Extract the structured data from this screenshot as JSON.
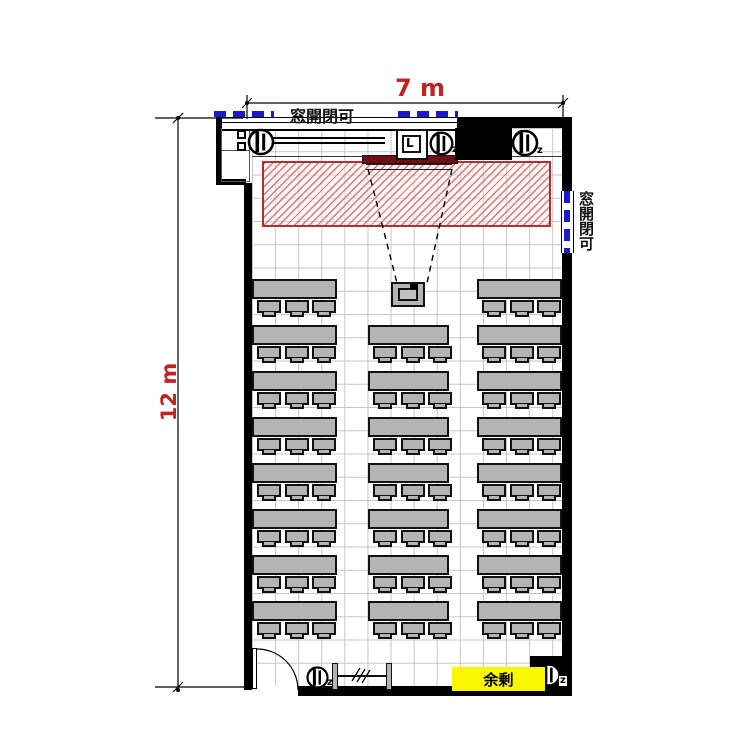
{
  "diagram": {
    "dimensions": {
      "width_label": "7 m",
      "height_label": "12 m",
      "color": "#c22222"
    },
    "windows": {
      "top_label": "窓開閉可",
      "right_label": "窓開閉可",
      "dash_color": "#1a1acc"
    },
    "labels": {
      "surplus": "余剰",
      "surplus_bg": "#f8f700",
      "clock": "L",
      "speaker_mark": "z"
    },
    "colors": {
      "wall": "#000000",
      "furniture": "#b4b4b4",
      "hatch_border": "#b03030",
      "hatch_line": "#d47a7a",
      "screen": "#6a1212",
      "grid": "#c6c6c6",
      "window_blue": "#1a1acc",
      "dimension_red": "#c22222"
    }
  },
  "floorplan": {
    "desks": {
      "table_height": 20,
      "chair": {
        "offsets": [
          5,
          33,
          60
        ],
        "width": 24,
        "height": 13,
        "tail_width": 14,
        "tail_height": 5
      },
      "columns": [
        {
          "name": "left",
          "x": 252,
          "width": 85,
          "rows": [
            279,
            325,
            371,
            417,
            463,
            509,
            555,
            601
          ]
        },
        {
          "name": "center",
          "x": 368,
          "width": 81,
          "rows": [
            325,
            371,
            417,
            463,
            509,
            555,
            601
          ]
        },
        {
          "name": "right",
          "x": 477,
          "width": 85,
          "rows": [
            279,
            325,
            371,
            417,
            463,
            509,
            555,
            601
          ]
        }
      ]
    },
    "speakers": [
      {
        "x": 246,
        "y": 127,
        "size": 30,
        "z": false,
        "on_dark": false
      },
      {
        "x": 428,
        "y": 130,
        "size": 27,
        "z": true,
        "on_dark": false
      },
      {
        "x": 510,
        "y": 128,
        "size": 30,
        "z": true,
        "on_dark": false
      },
      {
        "x": 305,
        "y": 665,
        "size": 25,
        "z": true,
        "on_dark": false
      },
      {
        "x": 536,
        "y": 662,
        "size": 26,
        "z": true,
        "on_dark": true
      }
    ]
  }
}
